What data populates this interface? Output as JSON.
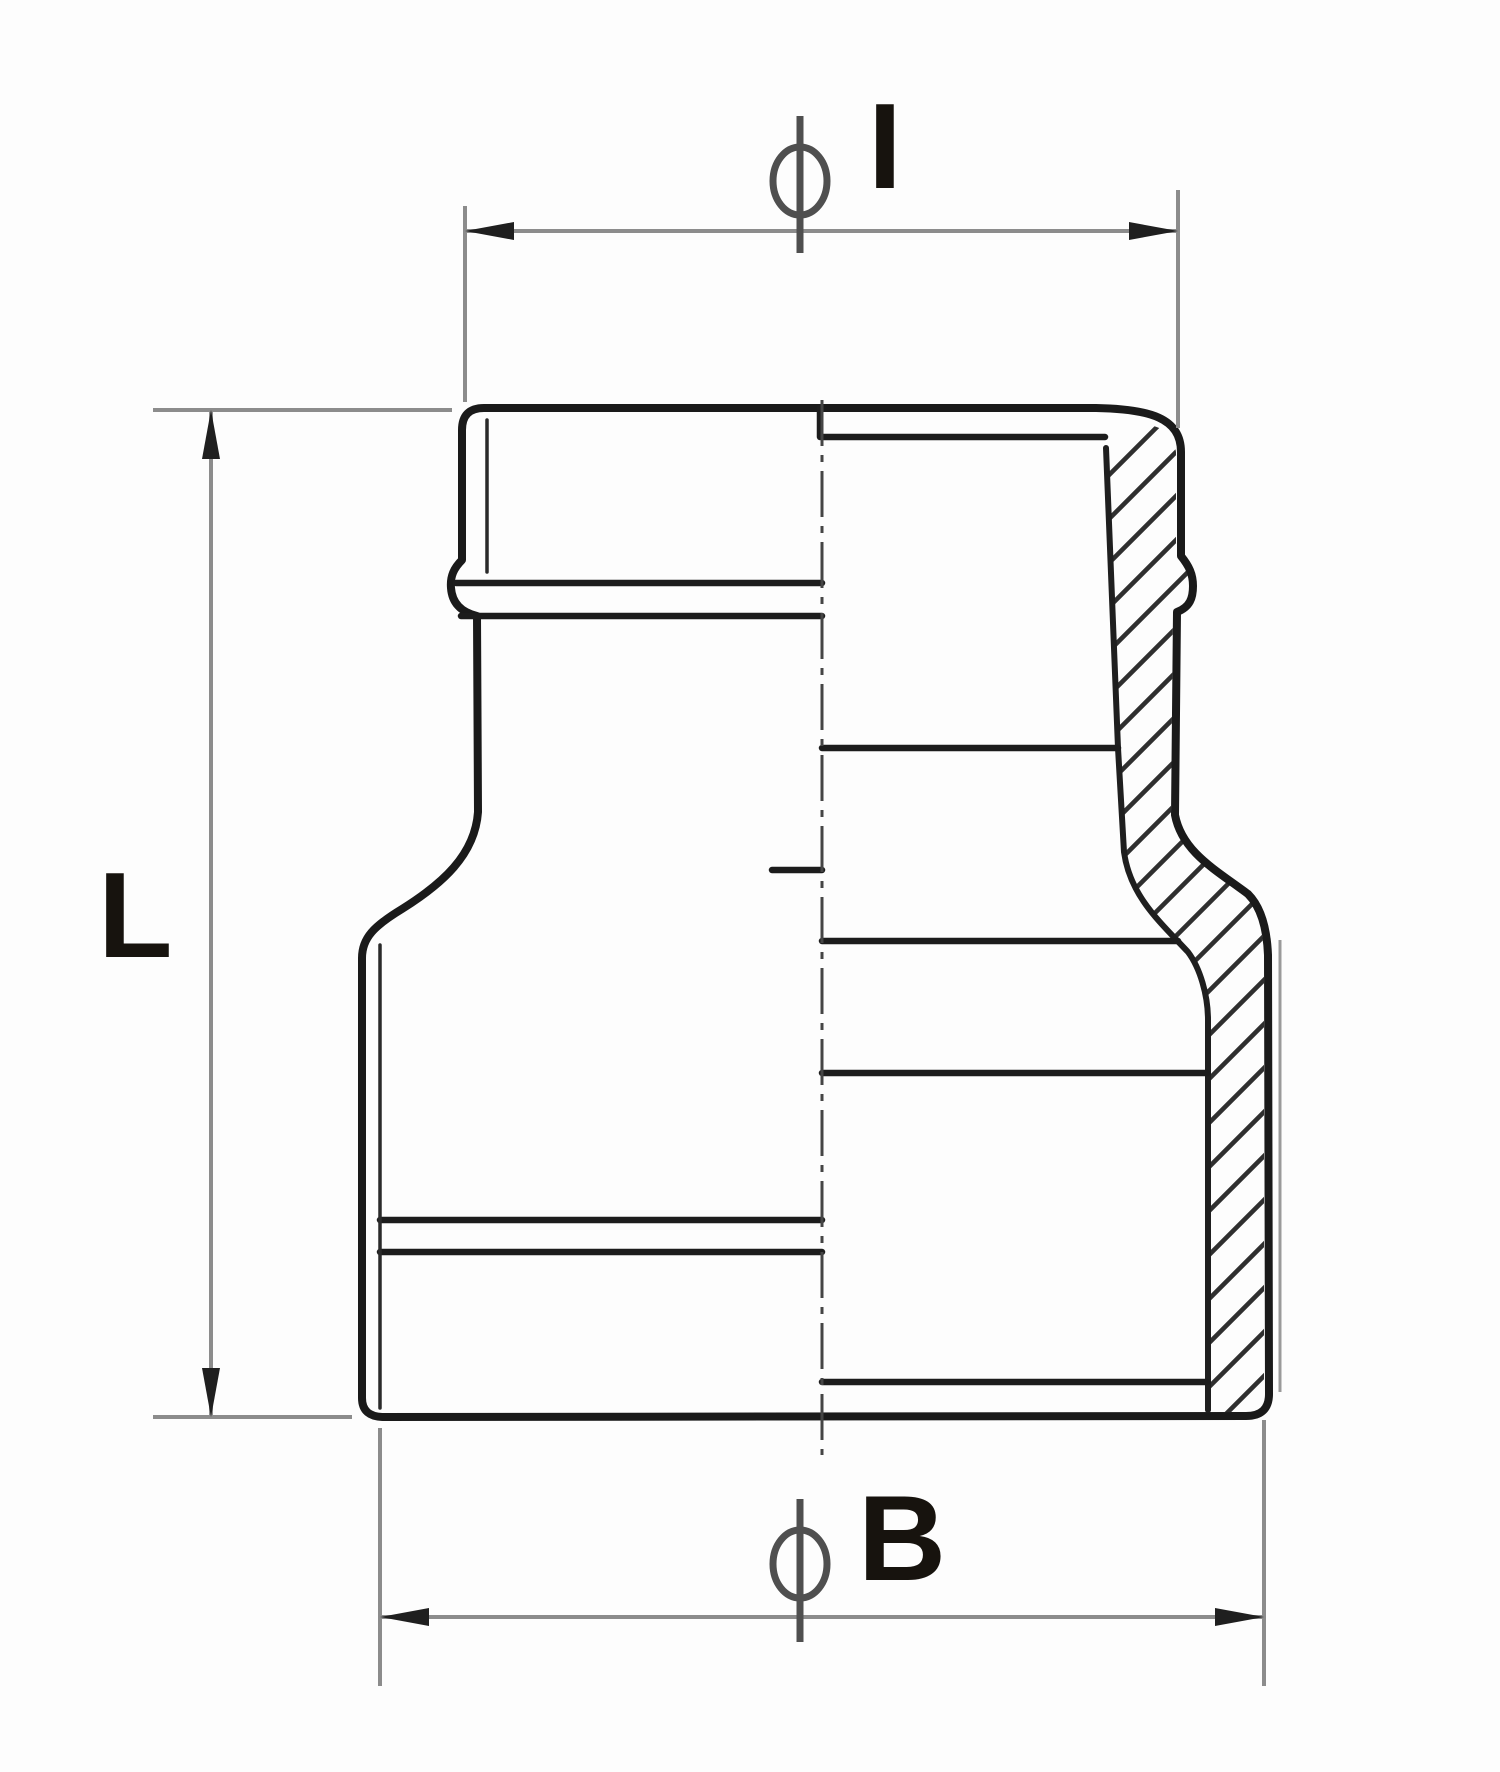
{
  "drawing": {
    "labels": {
      "top_dimension": "I",
      "left_dimension": "L",
      "bottom_dimension": "B"
    },
    "symbols": {
      "diameter": "⌀"
    },
    "colors": {
      "outline": "#1a1a1a",
      "thin_line": "#2a2a2a",
      "hatch": "#2f2f2f",
      "dimension_lines": "#8c8c8c",
      "extension_lines": "#8c8c8c",
      "arrowheads": "#1f1f1f",
      "centerline": "#454545",
      "diameter_symbol": "#4f4f4f",
      "label_text": "#17130e",
      "background": "#ffffff"
    }
  }
}
